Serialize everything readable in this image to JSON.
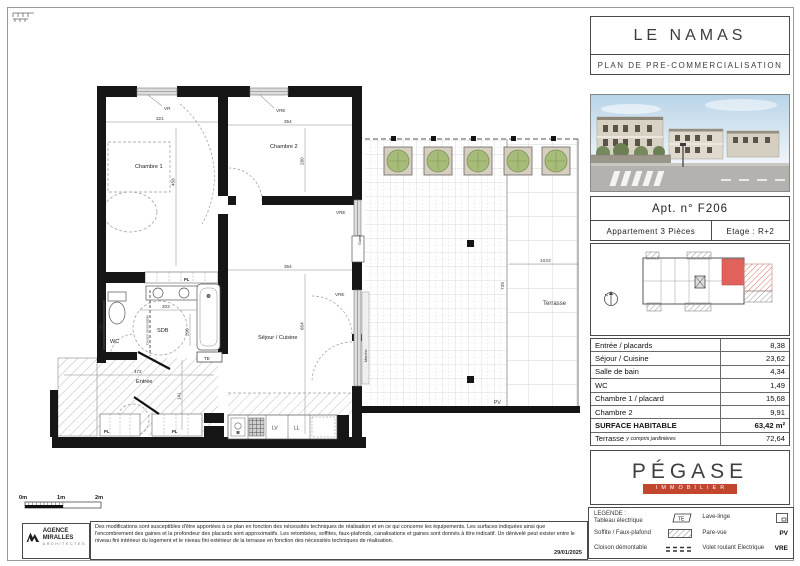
{
  "header": {
    "title": "LE NAMAS",
    "subtitle": "PLAN DE PRE-COMMERCIALISATION"
  },
  "apt": {
    "number": "Apt. n° F206",
    "type": "Appartement  3  Pièces",
    "floor": "Etage :  R+2"
  },
  "table": {
    "rows": [
      {
        "label": "Entrée / placards",
        "value": "8,38"
      },
      {
        "label": "Séjour / Cuisine",
        "value": "23,62"
      },
      {
        "label": "Salle de bain",
        "value": "4,34"
      },
      {
        "label": "WC",
        "value": "1,49"
      },
      {
        "label": "Chambre 1 / placard",
        "value": "15,68"
      },
      {
        "label": "Chambre 2",
        "value": "9,91"
      }
    ],
    "total_label": "SURFACE HABITABLE",
    "total_value": "63,42 m²",
    "terrasse_label": "Terrasse",
    "terrasse_note": "y compris jardinières",
    "terrasse_value": "72,64"
  },
  "brand": {
    "name": "PÉGASE",
    "tagline": "IMMOBILIER",
    "accent_color": "#c2452e"
  },
  "legend": {
    "title": "LEGENDE :",
    "left": [
      {
        "label": "Tableau électrique",
        "symbol": "TE"
      },
      {
        "label": "Soffite / Faux-plafond",
        "symbol": ""
      },
      {
        "label": "Cloison démontable",
        "symbol": ""
      }
    ],
    "right": [
      {
        "label": "Lave-linge",
        "symbol": ""
      },
      {
        "label": "Pare-vue",
        "symbol": "PV"
      },
      {
        "label": "Volet roulant Electrique",
        "symbol": "VRE"
      }
    ]
  },
  "scale": {
    "m0": "0m",
    "m1": "1m",
    "m2": "2m"
  },
  "footer": {
    "agency_l1": "AGENCE",
    "agency_l2": "MIRALLES",
    "agency_l3": "ARCHITECTES",
    "disclaimer": "Des modifications sont susceptibles d'être apportées à ce plan en fonction des nécessités techniques de réalisation et en ce qui concerne les équipements. Les surfaces indiquées ainsi que l'encombrement des gaines et la profondeur des placards sont approximatifs. Les retombées, soffites, faux-plafonds, canalisations et gaines sont donnés à titre indicatif. Un dénivelé peut exister entre le niveau fini intérieur du logement et le niveau fini extérieur de la terrasse en fonction des nécessités techniques de réalisation.",
    "date": "29/01/2025"
  },
  "plan": {
    "labels": {
      "chambre1": "Chambre 1",
      "chambre2": "Chambre 2",
      "sejour": "Séjour / Cuisine",
      "wc": "WC",
      "sdb": "SDB",
      "entree": "Entrée",
      "terrasse": "Terrasse",
      "vr": "VR",
      "vre": "VRE",
      "gaine": "Gaine",
      "marche": "Marche",
      "te": "TE",
      "pl": "PL",
      "pv": "PV",
      "lv": "LV",
      "ll": "LL",
      "cloison": "Cloison démontable"
    },
    "dims": {
      "d321": "321",
      "d458": "458",
      "d354": "354",
      "d280": "280",
      "d654": "654",
      "d472": "472",
      "d141": "141",
      "d203": "203",
      "d206": "206",
      "d150": "150",
      "d1023": "1023",
      "d735": "735"
    },
    "unit_highlight_color": "#e0625a",
    "planter_color": "#a7bc79"
  }
}
